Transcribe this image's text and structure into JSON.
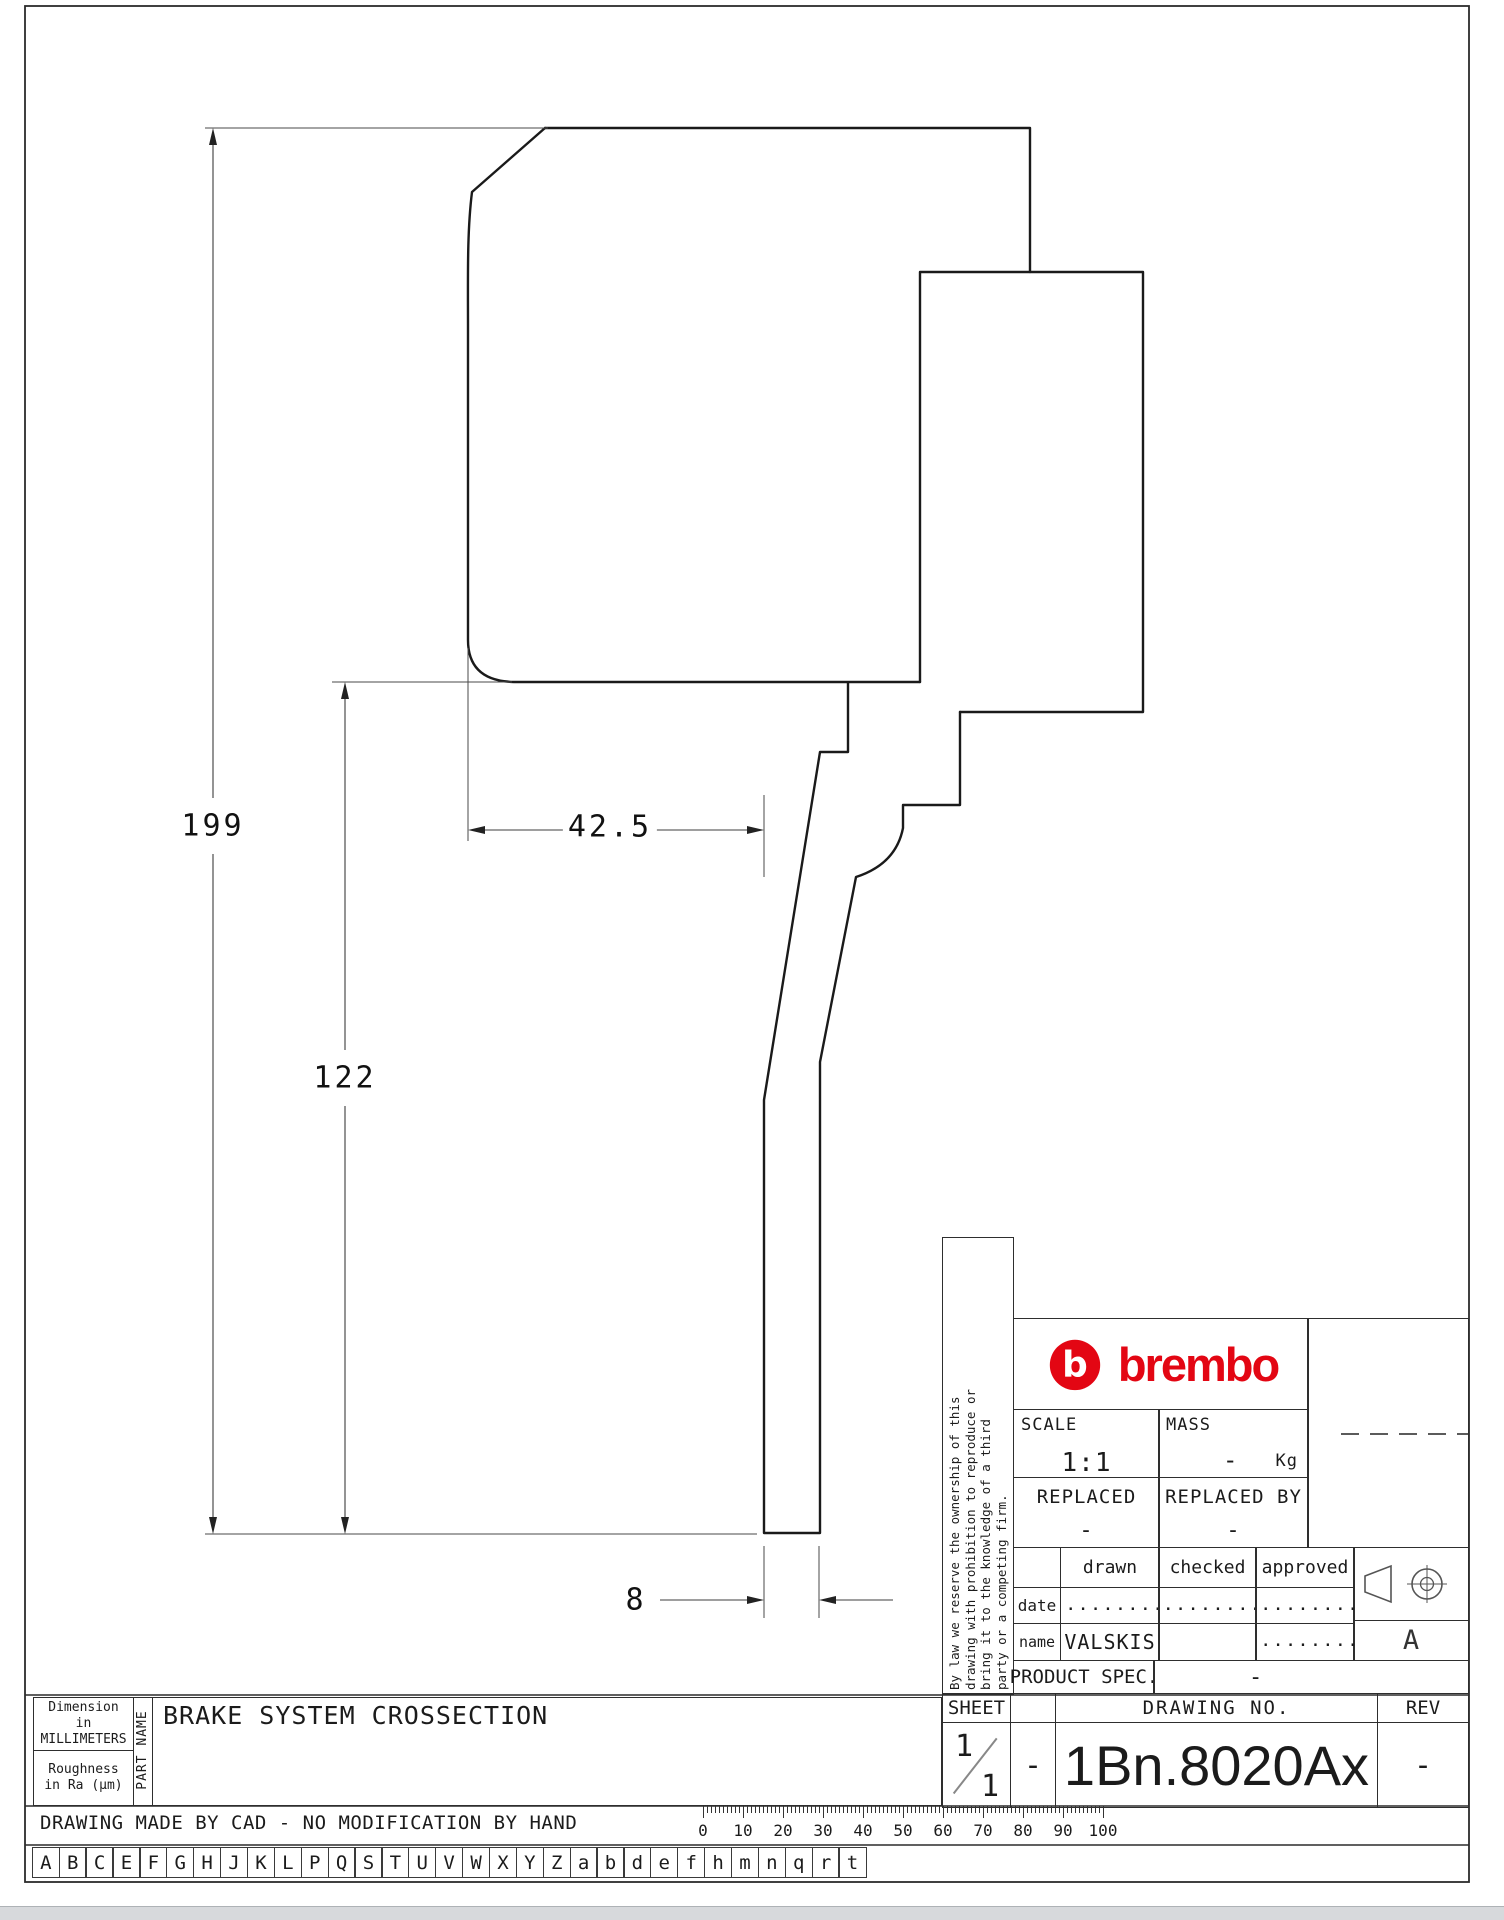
{
  "dims": {
    "total_height": "199",
    "lower_height": "122",
    "upper_width": "42.5",
    "leg_width": "8"
  },
  "band": {
    "dimensions_label": "Dimension\nin MILLIMETERS",
    "roughness_label": "Roughness\nin Ra (μm)",
    "part_name_label": "PART NAME",
    "part_title": "BRAKE SYSTEM CROSSECTION",
    "cad_note": "DRAWING MADE BY CAD - NO MODIFICATION BY HAND"
  },
  "title_block": {
    "legal": "By law we reserve the ownership of this\ndrawing with prohibition to reproduce or\nbring it to the knowledge of a third\nparty or a competing firm.",
    "brand": "brembo",
    "brand_color": "#e30613",
    "scale_label": "SCALE",
    "scale_value": "1:1",
    "mass_label": "MASS",
    "mass_value": "-",
    "mass_unit": "Kg",
    "replaced_label": "REPLACED",
    "replaced_value": "-",
    "replaced_by_label": "REPLACED BY",
    "replaced_by_value": "-",
    "drawn_label": "drawn",
    "checked_label": "checked",
    "approved_label": "approved",
    "date_label": "date",
    "name_label": "name",
    "dots": ".........",
    "drawn_name": "VALSKIS",
    "product_spec_label": "PRODUCT SPEC.",
    "product_spec_value": "-",
    "sheet_label": "SHEET",
    "sheet_num": "1",
    "sheet_den": "1",
    "col2_value": "-",
    "drawing_no_label": "DRAWING NO.",
    "drawing_no": "1Bn.8020Ax",
    "rev_label": "REV",
    "rev_value": "-",
    "projection_letter": "A"
  },
  "ruler": {
    "labels": [
      "0",
      "10",
      "20",
      "30",
      "40",
      "50",
      "60",
      "70",
      "80",
      "90",
      "100"
    ]
  },
  "alphabet": [
    "A",
    "B",
    "C",
    "E",
    "F",
    "G",
    "H",
    "J",
    "K",
    "L",
    "P",
    "Q",
    "S",
    "T",
    "U",
    "V",
    "W",
    "X",
    "Y",
    "Z",
    "a",
    "b",
    "d",
    "e",
    "f",
    "h",
    "m",
    "n",
    "q",
    "r",
    "t"
  ]
}
